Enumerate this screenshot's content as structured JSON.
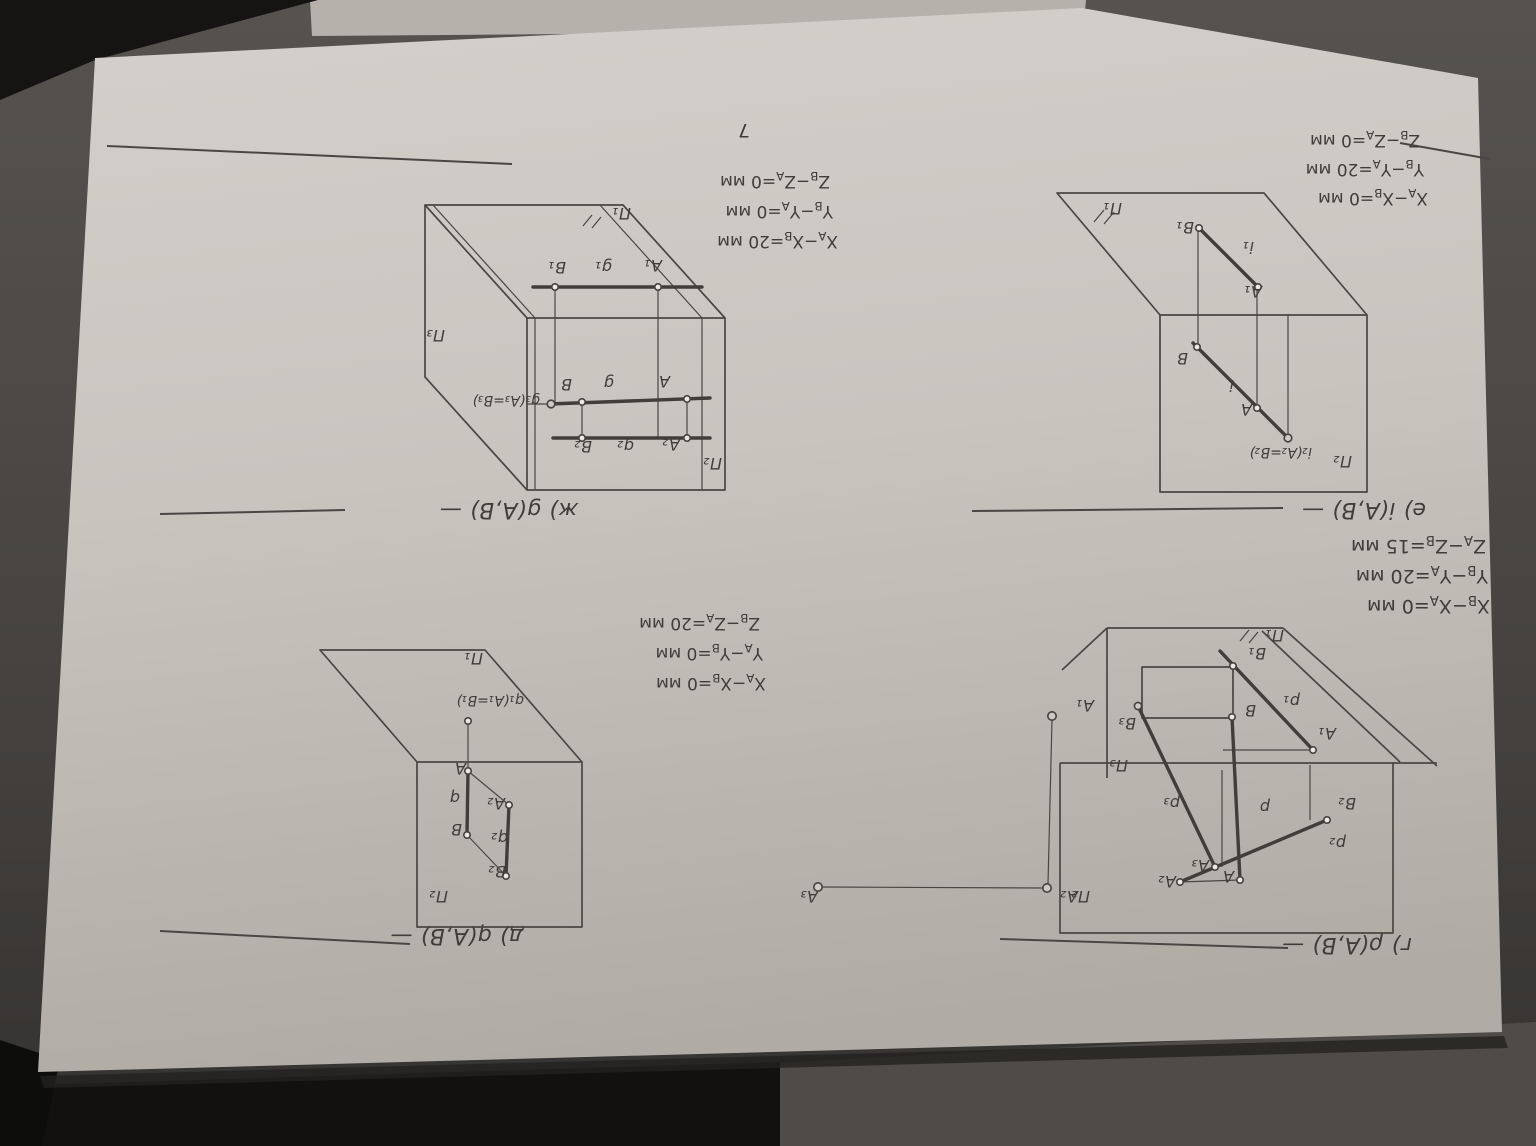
{
  "page_number": "7",
  "tasks": {
    "g_rho": {
      "title": "г) ρ(A,B) —",
      "conditions": [
        "X_B−X_A=0 мм",
        "Y_B−Y_A=20 мм",
        "Z_A−Z_B=15 мм"
      ],
      "labels": {
        "pi1": "П₁",
        "pi2": "П₂",
        "pi3": "П₃",
        "B1": "B₁",
        "p1": "p₁",
        "A1": "A₁",
        "B": "B",
        "B3": "B₃",
        "p3": "p₃",
        "p": "p",
        "A3": "A₃",
        "A": "A",
        "A2": "A₂",
        "p2": "p₂",
        "B2": "B₂",
        "ax_A1": "A₁",
        "ax_A2": "A₂",
        "ax_A3": "A₃"
      }
    },
    "d_q": {
      "title": "д) q(A,B) —",
      "conditions": [
        "X_A−X_B=0 мм",
        "Y_A−Y_B=0 мм",
        "Z_B−Z_A=20 мм"
      ],
      "labels": {
        "pi2": "П₂",
        "pi1": "П₁",
        "q1": "q₁(A₁=B₁)",
        "A": "A",
        "q": "q",
        "B": "B",
        "A2": "A₂",
        "q2": "q₂",
        "B2": "B₂"
      }
    },
    "e_i": {
      "title": "е) i(A,B) —",
      "conditions": [
        "X_A−X_B=0 мм",
        "Y_B−Y_A=20 мм",
        "Z_B−Z_A=0 мм"
      ],
      "labels": {
        "pi2": "П₂",
        "i2": "i₂(A₂=B₂)",
        "A": "A",
        "i": "i",
        "B": "B",
        "pi1": "П₁",
        "B1": "B₁",
        "i1": "i₁",
        "A1": "A₁"
      }
    },
    "zh_g": {
      "title": "ж) g(A,B) —",
      "conditions": [
        "X_A−X_B=20 мм",
        "Y_B−Y_A=0 мм",
        "Z_B−Z_A=0 мм"
      ],
      "labels": {
        "pi1": "П₁",
        "pi3": "П₃",
        "pi2": "П₂",
        "B1": "B₁",
        "g1": "g₁",
        "A1": "A₁",
        "B": "B",
        "g": "g",
        "A": "A",
        "g3": "g₃(A₃=B₃)",
        "B2": "B₂",
        "g2": "g₂",
        "A2": "A₂"
      }
    }
  }
}
